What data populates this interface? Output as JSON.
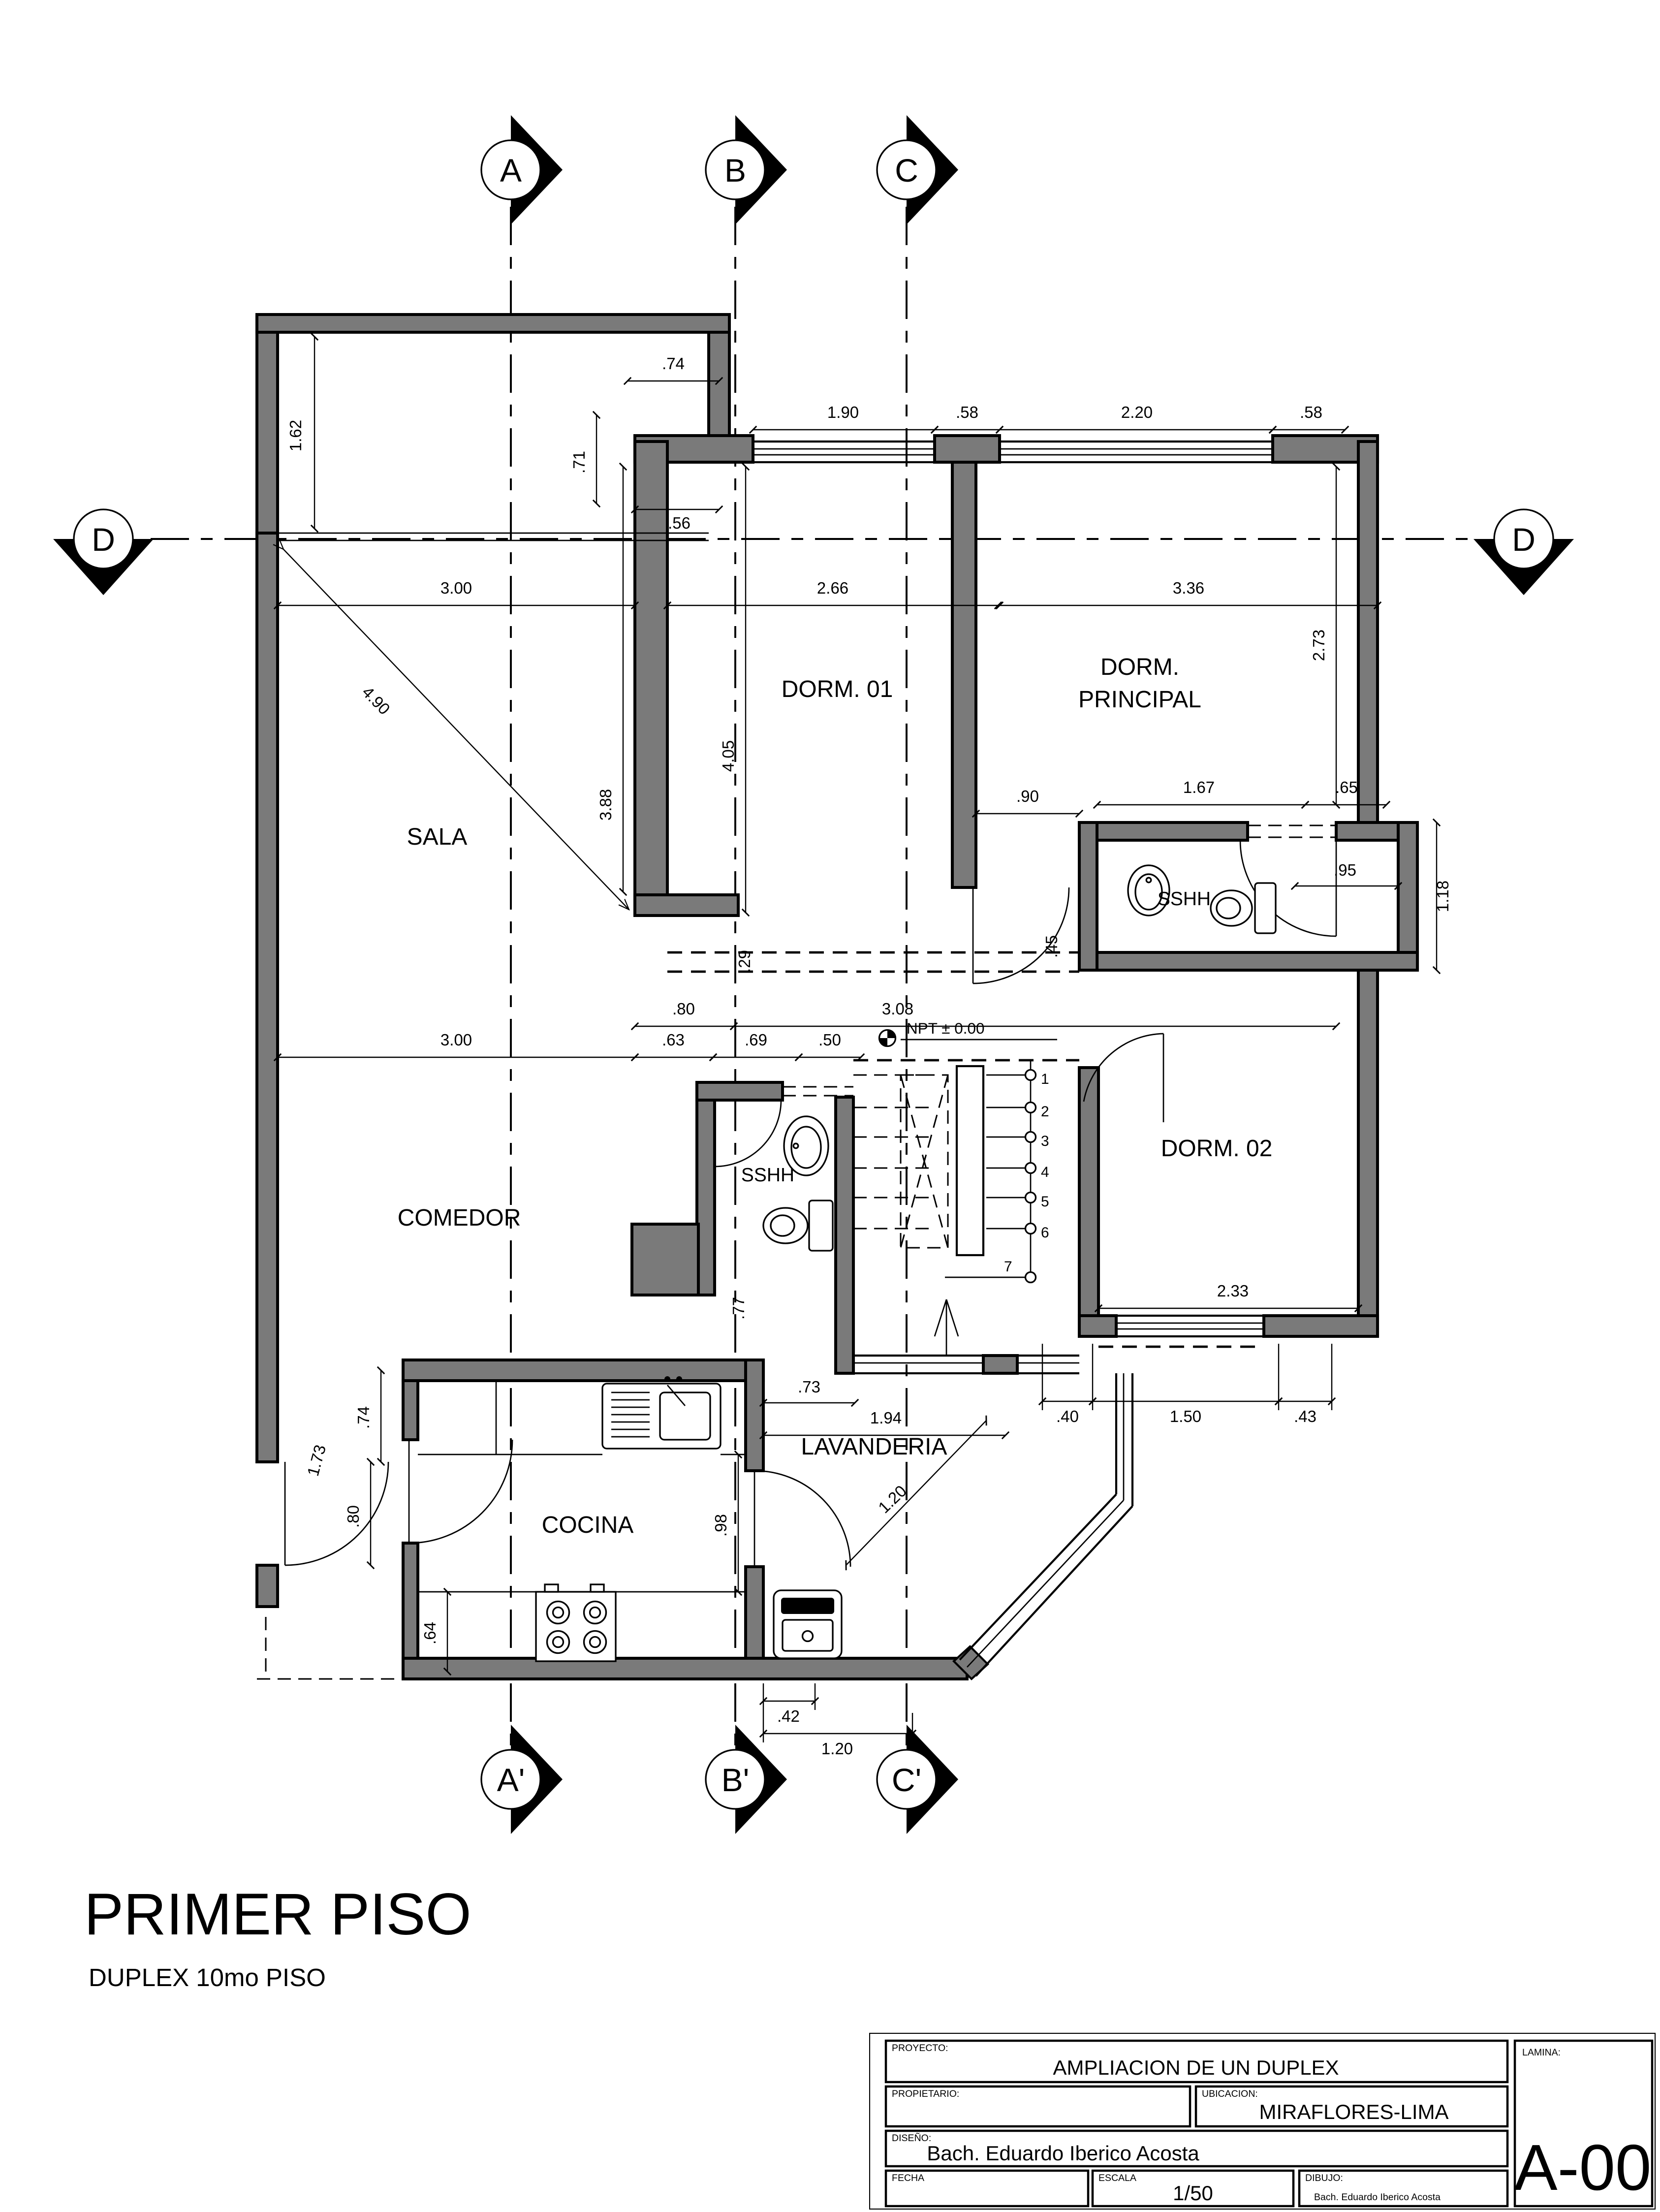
{
  "drawing_title": {
    "main": "PRIMER PISO",
    "sub": "DUPLEX 10mo PISO"
  },
  "markers": {
    "top": [
      "A",
      "B",
      "C"
    ],
    "bottom": [
      "A'",
      "B'",
      "C'"
    ],
    "left": "D",
    "right": "D"
  },
  "rooms": {
    "sala": "SALA",
    "dorm01": "DORM. 01",
    "dormp1": "DORM.",
    "dormp2": "PRINCIPAL",
    "sshh1": "SSHH",
    "dorm02": "DORM. 02",
    "comedor": "COMEDOR",
    "sshh2": "SSHH",
    "cocina": "COCINA",
    "lavanderia": "LAVANDERIA"
  },
  "level": {
    "npt": "NPT ±  0.00"
  },
  "stairs": {
    "steps": [
      "1",
      "2",
      "3",
      "4",
      "5",
      "6",
      "7"
    ]
  },
  "dims": {
    "t162": "1.62",
    "t74": ".74",
    "t71": ".71",
    "t56": ".56",
    "t190": "1.90",
    "t58a": ".58",
    "t220": "2.20",
    "t58b": ".58",
    "t300a": "3.00",
    "t266": "2.66",
    "t336": "3.36",
    "t273": "2.73",
    "t490": "4.90",
    "t388": "3.88",
    "t405": "4.05",
    "t90": ".90",
    "t167": "1.67",
    "t65": ".65",
    "t95": ".95",
    "t118": "1.18",
    "t29": ".29",
    "t45": ".45",
    "t80a": ".80",
    "t308": "3.08",
    "t300b": "3.00",
    "t63": ".63",
    "t69": ".69",
    "t50": ".50",
    "t233": "2.33",
    "t40": ".40",
    "t150": "1.50",
    "t43": ".43",
    "t77": ".77",
    "t73": ".73",
    "t194": "1.94",
    "t120d": "1.20",
    "t74b": ".74",
    "t173": "1.73",
    "t80b": ".80",
    "t98": ".98",
    "t64": ".64",
    "t42": ".42",
    "t120b": "1.20"
  },
  "titleblock": {
    "proyecto_label": "PROYECTO:",
    "proyecto": "AMPLIACION DE UN DUPLEX",
    "propietario_label": "PROPIETARIO:",
    "propietario": "",
    "ubicacion_label": "UBICACION:",
    "ubicacion": "MIRAFLORES-LIMA",
    "diseno_label": "DISEÑO:",
    "diseno": "Bach. Eduardo Iberico Acosta",
    "fecha_label": "FECHA",
    "fecha": "",
    "escala_label": "ESCALA",
    "escala": "1/50",
    "dibujo_label": "DIBUJO:",
    "dibujo": "Bach. Eduardo Iberico Acosta",
    "lamina_label": "LAMINA:",
    "lamina": "A-00"
  },
  "colors": {
    "wall": "#7a7a7a",
    "line": "#000000",
    "background": "#ffffff"
  }
}
